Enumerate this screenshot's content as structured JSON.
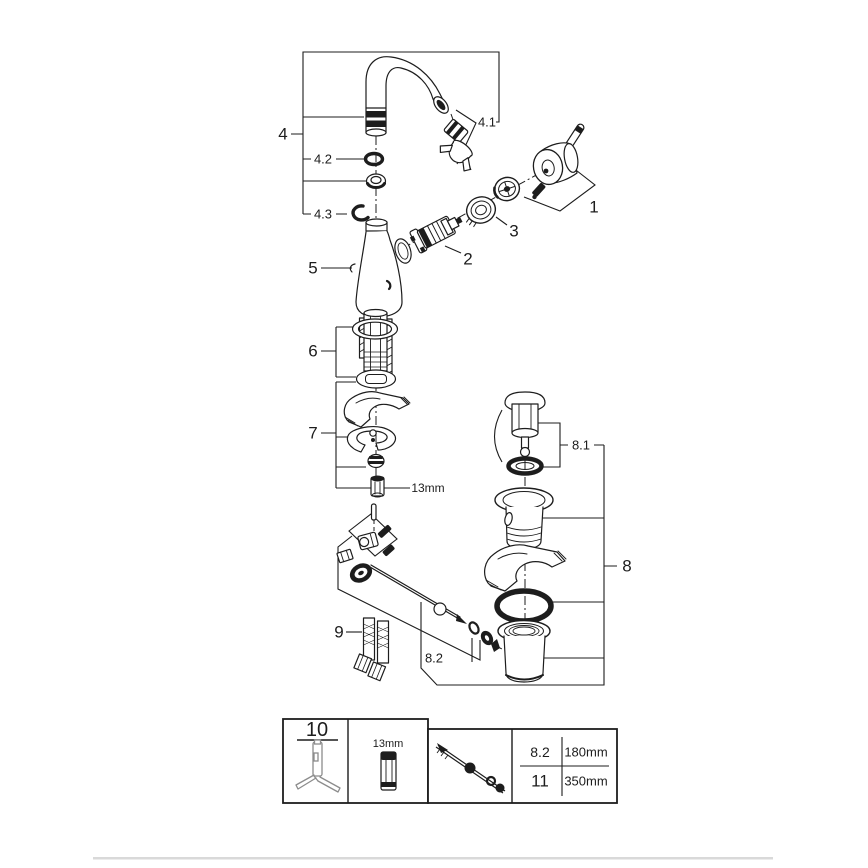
{
  "diagram": {
    "part_labels": {
      "p1": "1",
      "p2": "2",
      "p3": "3",
      "p4": "4",
      "p5": "5",
      "p6": "6",
      "p7": "7",
      "p8": "8",
      "p9": "9"
    },
    "sub_labels": {
      "p4_1": "4.1",
      "p4_2": "4.2",
      "p4_3": "4.3",
      "p8_1": "8.1",
      "p8_2": "8.2"
    },
    "wrench_size": "13mm"
  },
  "legend_table": {
    "tool_ref": "10",
    "socket_size": "13mm",
    "rows": [
      {
        "ref": "8.2",
        "length": "180mm"
      },
      {
        "ref": "11",
        "length": "350mm"
      }
    ]
  },
  "colors": {
    "line": "#1d1d1d",
    "tool_gray": "#8c8c8c",
    "footer_divider": "#d9d9d9"
  }
}
